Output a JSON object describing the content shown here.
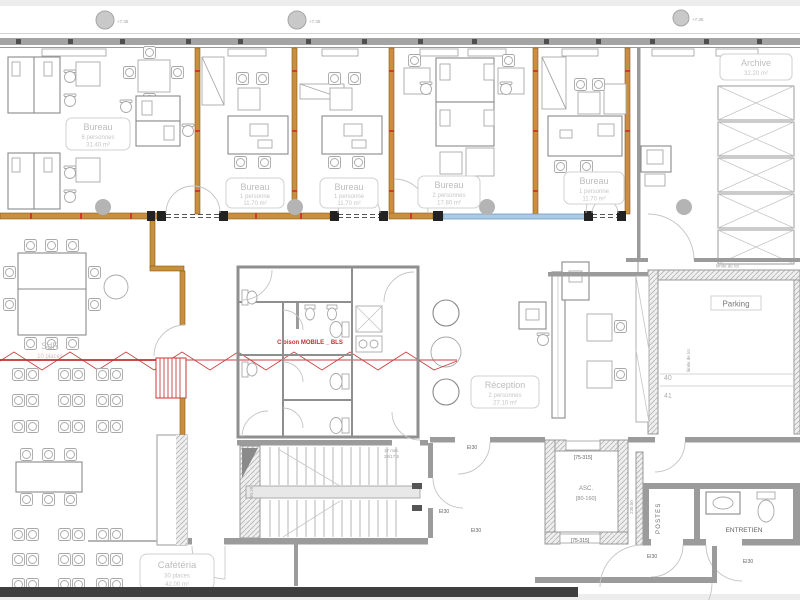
{
  "plan": {
    "colors": {
      "wall": "#9b9b9b",
      "wood_partition": "#c78f3f",
      "glass_partition": "#a9cbe5",
      "mobile_partition_red": "#c43a35",
      "column": "#b4b4b4",
      "dark_band": "#3f3f3f",
      "label_text": "#bdbdbd",
      "hatch_fill": "#efefef"
    },
    "markers": {
      "level": "+7.35"
    },
    "rooms": {
      "bureau_6p": {
        "name": "Bureau",
        "capacity": "6 personnes",
        "area": "31.40 m²"
      },
      "bureau_1p_a": {
        "name": "Bureau",
        "capacity": "1 personne",
        "area": "11.70 m²"
      },
      "bureau_1p_b": {
        "name": "Bureau",
        "capacity": "1 personne",
        "area": "11.70 m²"
      },
      "bureau_2p": {
        "name": "Bureau",
        "capacity": "2 personnes",
        "area": "17.80 m²"
      },
      "bureau_1p_c": {
        "name": "Bureau",
        "capacity": "1 personne",
        "area": "11.70 m²"
      },
      "archive": {
        "name": "Archive",
        "area": "32.20 m²"
      },
      "sdr": {
        "name": "SdR",
        "capacity": "10 places"
      },
      "reception": {
        "name": "Réception",
        "capacity": "2 personnes",
        "area": "27.10 m²"
      },
      "cafeteria": {
        "name": "Cafétéria",
        "capacity": "30 places",
        "area": "42.00 m²"
      },
      "parking": {
        "name": "Parking",
        "spots": [
          "40",
          "41"
        ]
      },
      "postes": {
        "name": "POSTES"
      },
      "entretien": {
        "name": "ENTRETIEN"
      },
      "ascenseur": {
        "name": "ASC.",
        "cabin": "[80-160]",
        "door_size": "[75-315]"
      }
    },
    "annotations": {
      "mobile_partition": "Cloison MOBILE _ BLS",
      "fire_door": "EI30",
      "stair_note_line1": "17 mar.",
      "stair_note_line2": "28/17,5",
      "stair_dim": "90.29",
      "corridor_dim": "230.50",
      "lot_limit": "limite de lot"
    }
  }
}
